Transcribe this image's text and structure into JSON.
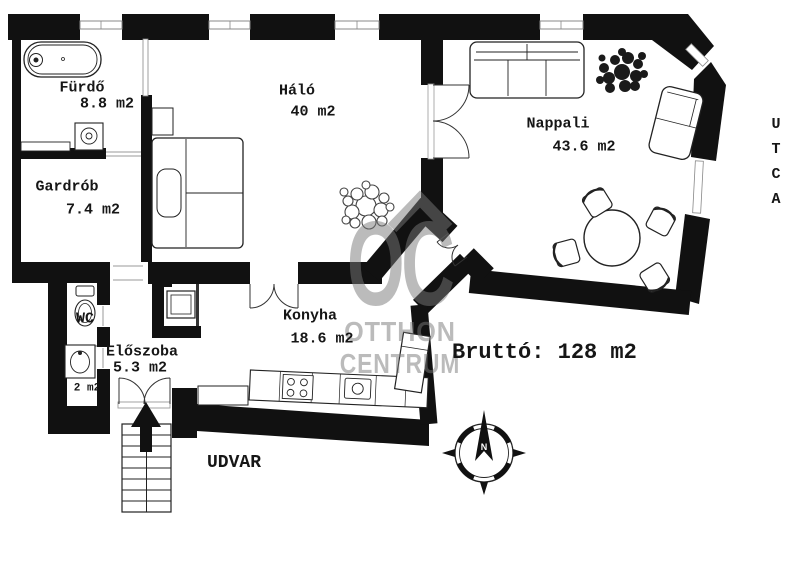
{
  "plan": {
    "rooms": [
      {
        "id": "furdo",
        "name": "Fürdő",
        "area": "8.8 m2"
      },
      {
        "id": "gardrob",
        "name": "Gardrób",
        "area": "7.4 m2"
      },
      {
        "id": "halo",
        "name": "Háló",
        "area": "40 m2"
      },
      {
        "id": "nappali",
        "name": "Nappali",
        "area": "43.6 m2"
      },
      {
        "id": "wc",
        "name": "WC",
        "area": ""
      },
      {
        "id": "kamra",
        "name": "",
        "area": "2 m2"
      },
      {
        "id": "eloszoba",
        "name": "Előszoba",
        "area": "5.3 m2"
      },
      {
        "id": "konyha",
        "name": "Konyha",
        "area": "18.6 m2"
      }
    ],
    "gross_area_label": "Bruttó: 128 m2",
    "courtyard_label": "UDVAR",
    "street_label": "UTCA",
    "compass_north_label": "N",
    "watermark": {
      "logo": "OC",
      "line1": "OTTHON",
      "line2": "CENTRUM"
    },
    "colors": {
      "wall": "#111111",
      "watermark_gray": "#7a7a7a",
      "window_line": "#888888"
    }
  }
}
